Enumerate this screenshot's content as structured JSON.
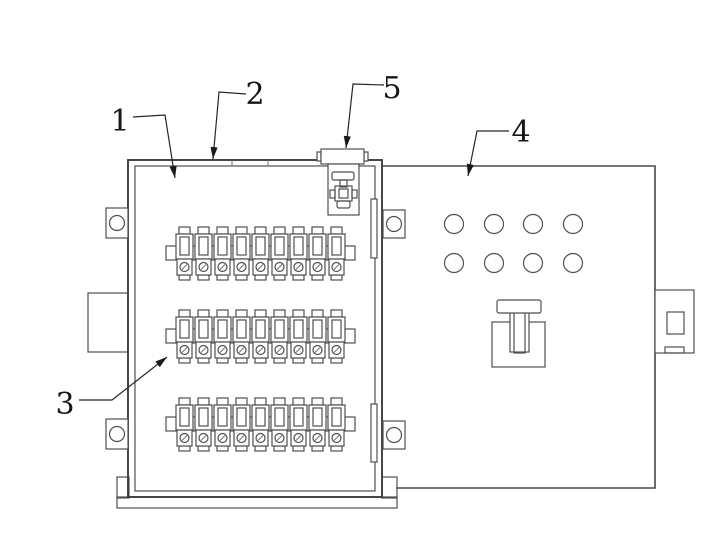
{
  "figure": {
    "kind": "patent-style-technical-drawing",
    "component": "wiring-terminal-junction-box",
    "canvas": {
      "w": 727,
      "h": 550
    },
    "colors": {
      "background": "#ffffff",
      "line": "#4f4f4f",
      "line_dark": "#3e3e3e",
      "line_thin": "#6f6f6f",
      "leader": "#262626",
      "label_text": "#161616"
    },
    "callouts": [
      {
        "number": "1",
        "points_to": "box-interior",
        "text_x": 120,
        "text_y": 131,
        "leader": "133,117 165,115 175,178"
      },
      {
        "number": "2",
        "points_to": "box-lid-top-wall",
        "text_x": 255,
        "text_y": 104,
        "leader": "246,94 219,92 213,159"
      },
      {
        "number": "3",
        "points_to": "terminal-strip",
        "text_x": 65,
        "text_y": 414,
        "leader": "79,400 112,400 167,357"
      },
      {
        "number": "4",
        "points_to": "side-panel",
        "text_x": 521,
        "text_y": 142,
        "leader": "509,131 477,131 468,176"
      },
      {
        "number": "5",
        "points_to": "cable-clamp",
        "text_x": 392,
        "text_y": 98,
        "leader": "384,85 353,84 346,148"
      }
    ],
    "left_box": {
      "outer": [
        128,
        160,
        254,
        337
      ],
      "inner": [
        135,
        166,
        240,
        325
      ],
      "lid_tick_x": [
        232,
        268
      ],
      "base_band": [
        117,
        497,
        280,
        11
      ],
      "feet": [
        [
          117,
          477,
          12,
          21
        ],
        [
          382,
          477,
          15,
          21
        ]
      ],
      "cable_entry": [
        88,
        293,
        40,
        59
      ],
      "hinge_bars": [
        [
          371,
          199,
          6,
          59
        ],
        [
          371,
          404,
          6,
          58
        ]
      ]
    },
    "mounting_lugs": {
      "hole_r": 7.5,
      "rects": [
        [
          106,
          208,
          22,
          30
        ],
        [
          106,
          419,
          22,
          30
        ],
        [
          383,
          210,
          22,
          28
        ],
        [
          383,
          421,
          22,
          28
        ]
      ]
    },
    "terminal_rows": {
      "rows": 3,
      "modules_per_row": 9,
      "row_tops": [
        227,
        310,
        398
      ],
      "x_start": 175,
      "module_width": 19,
      "rail": {
        "x": 166,
        "w": 189,
        "dy": 19,
        "h": 14
      }
    },
    "side_panel": {
      "outline": "382,166 655,166 655,488 396,488",
      "vent_holes": {
        "cx": [
          454,
          494,
          533,
          573
        ],
        "cy": [
          224,
          263
        ],
        "r": 9.5
      },
      "handle": {
        "plate": [
          492,
          322,
          53,
          45
        ],
        "bar": [
          497,
          300,
          44,
          13
        ],
        "stem_outer": [
          510,
          306,
          19,
          46
        ],
        "stem_inner": [
          514,
          310,
          11,
          43
        ]
      },
      "latch_bracket": {
        "outer": [
          655,
          290,
          39,
          63
        ],
        "window": [
          667,
          312,
          17,
          22
        ],
        "notch": [
          665,
          347,
          19,
          6
        ]
      }
    },
    "cable_clamp": {
      "bar": [
        321,
        149,
        43,
        15
      ],
      "bar_tabs": [
        [
          317,
          152,
          4,
          9
        ],
        [
          364,
          152,
          4,
          9
        ]
      ],
      "housing": [
        328,
        164,
        31,
        51
      ],
      "inner_bar": [
        332,
        172,
        22,
        8
      ],
      "inner_stem": [
        340,
        180,
        7,
        7
      ],
      "mid_square": [
        335,
        186,
        17,
        15
      ],
      "mid_square_inner": [
        339,
        189,
        9,
        9
      ],
      "side_tabs": [
        [
          330,
          190,
          5,
          8
        ],
        [
          352,
          190,
          5,
          8
        ]
      ],
      "foot": [
        337,
        201,
        13,
        7
      ]
    }
  }
}
